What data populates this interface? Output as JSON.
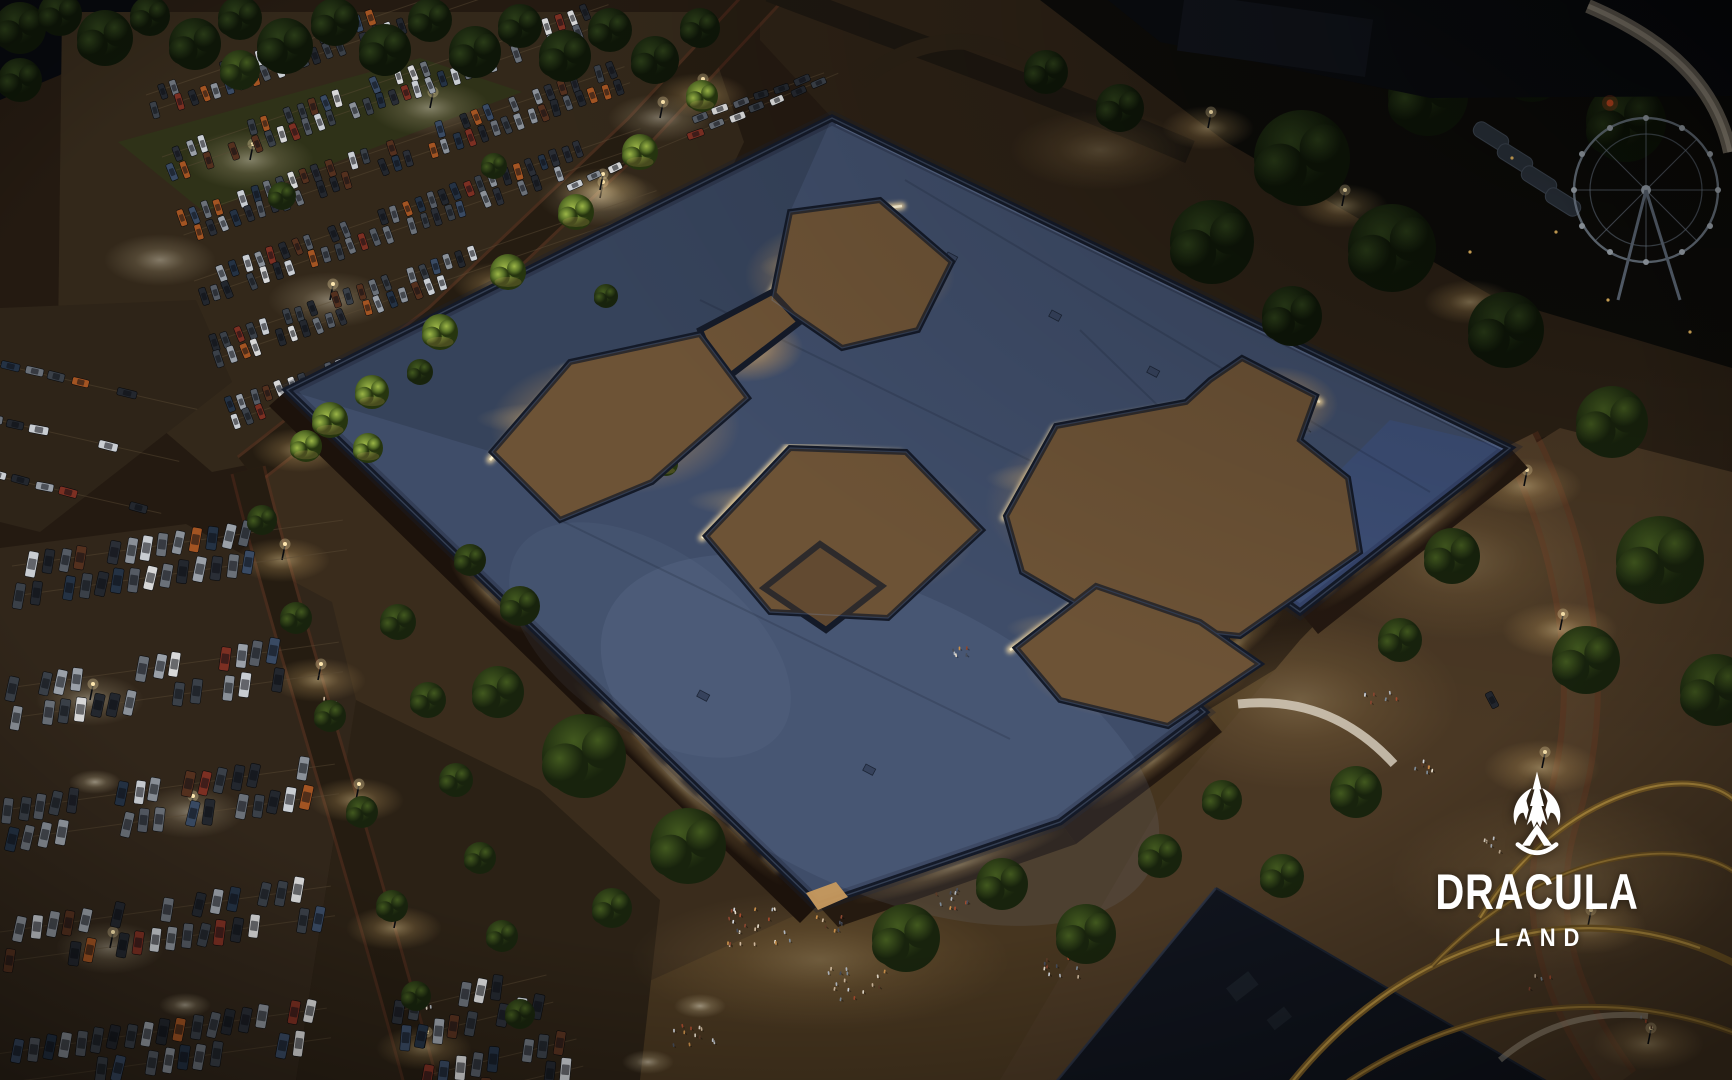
{
  "scene": {
    "description": "Aerial night rendering of the Dracula Land shopping village: a large slate-blue pinwheel roof with glowing interior courtyards, crowded plazas, tree-lined streets, full parking lots, a ferris wheel and a golden roller coaster.",
    "palette": {
      "night_ground": "#231a10",
      "roof_blue": "#3f4d69",
      "roof_blue_bright": "#3d5aa8",
      "roof_edge": "#141a28",
      "courtyard_warm": "#6d5336",
      "storefront_glow": "#ffe3a8",
      "window_amber": "#ffd27f",
      "lawn_green": "#a8b545",
      "tree_dark": "#16200e",
      "tree_lit": "#86a23c",
      "street_light": "#ffdfa0",
      "coaster_gold": "#8a6c34",
      "logo_white": "#ffffff"
    }
  },
  "logo": {
    "brand": "DRACULA",
    "subtitle": "LAND",
    "icon": "castle-crest-icon"
  }
}
